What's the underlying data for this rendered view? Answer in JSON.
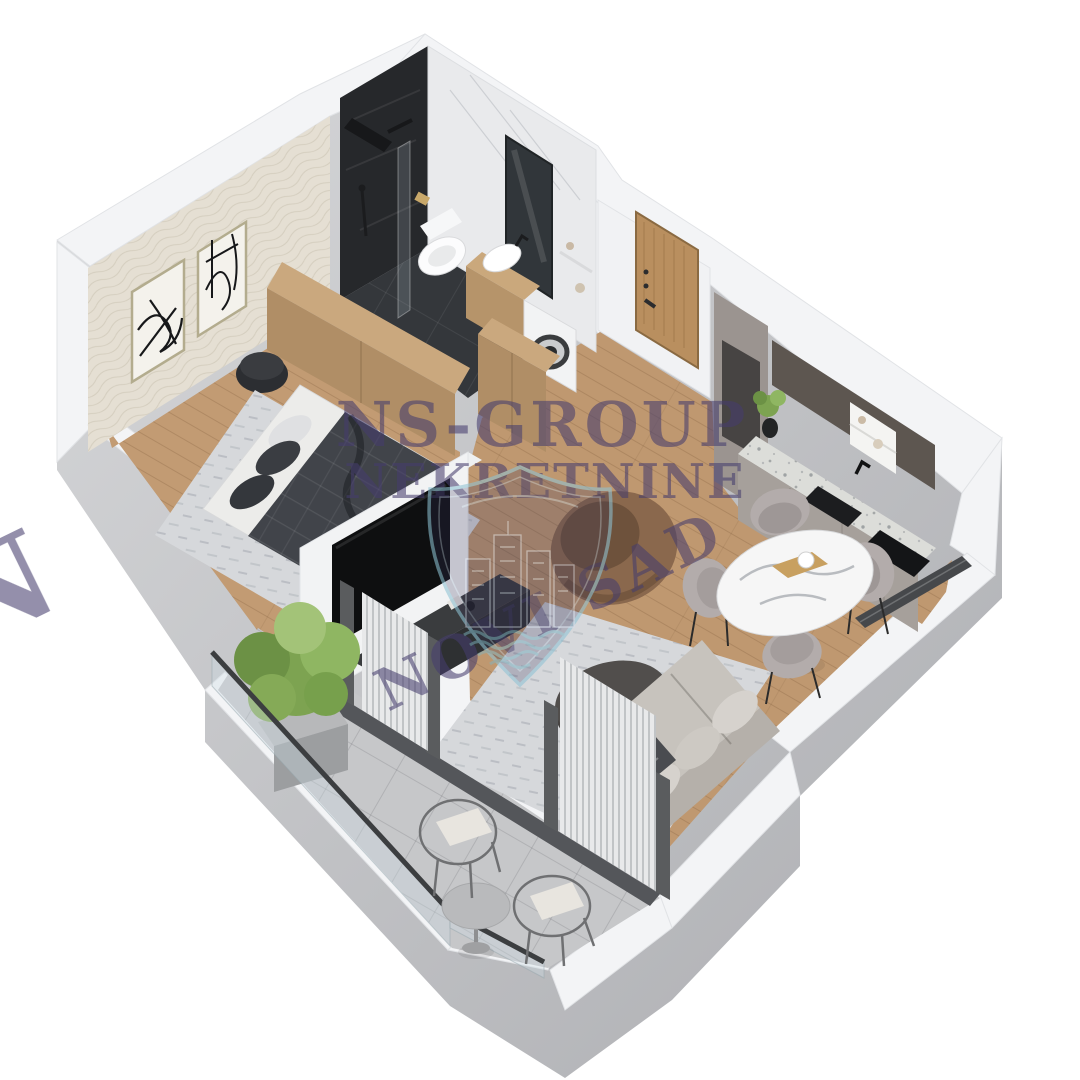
{
  "title": "3D isometric apartment floor plan render",
  "watermark": {
    "line1": "NS-GROUP",
    "line2": "NEKRETNINE",
    "line3": "NOVI SAD",
    "edge_letter": "N",
    "color": "#463e6e",
    "logo": "novi-sad-city-shield-emblem",
    "logo_outline_color": "#8fc3d4"
  },
  "palette": {
    "background": "#ffffff",
    "wall_top": "#f3f4f6",
    "wall_side": "#bfc0c4",
    "wood_floor": "#c29b73",
    "bathroom_tile": "#34373b",
    "marble_wall": "#e9eaec",
    "wallpaper": "#e5dfd3",
    "balcony_tile": "#c6c7c9",
    "rug": "#d6d8db",
    "sofa": "#c7c3bd",
    "armchair_leather": "#8a684d",
    "duvet": "#41444a",
    "cabinet_wood": "#c2a077",
    "kitchen_cabinet": "#a29b96",
    "kitchen_upper": "#5d5650",
    "terrazzo": "#dcddd9",
    "plant": "#7da351",
    "tv": "#0e0f10"
  },
  "scene": {
    "rooms": [
      "bedroom",
      "bathroom",
      "hallway",
      "kitchen",
      "living-dining",
      "balcony"
    ],
    "furniture": [
      "double-bed",
      "wardrobe",
      "pouf",
      "wall-art",
      "shower",
      "toilet",
      "vanity-sink",
      "washing-machine",
      "mirror",
      "entry-door",
      "kitchen-counter",
      "sink",
      "cooktop",
      "dining-table",
      "dining-chairs",
      "tv-partition",
      "tv-console",
      "armchair",
      "sofa",
      "coffee-table",
      "balcony-plant",
      "bistro-table",
      "wire-chairs",
      "glass-railing",
      "curtains"
    ]
  }
}
